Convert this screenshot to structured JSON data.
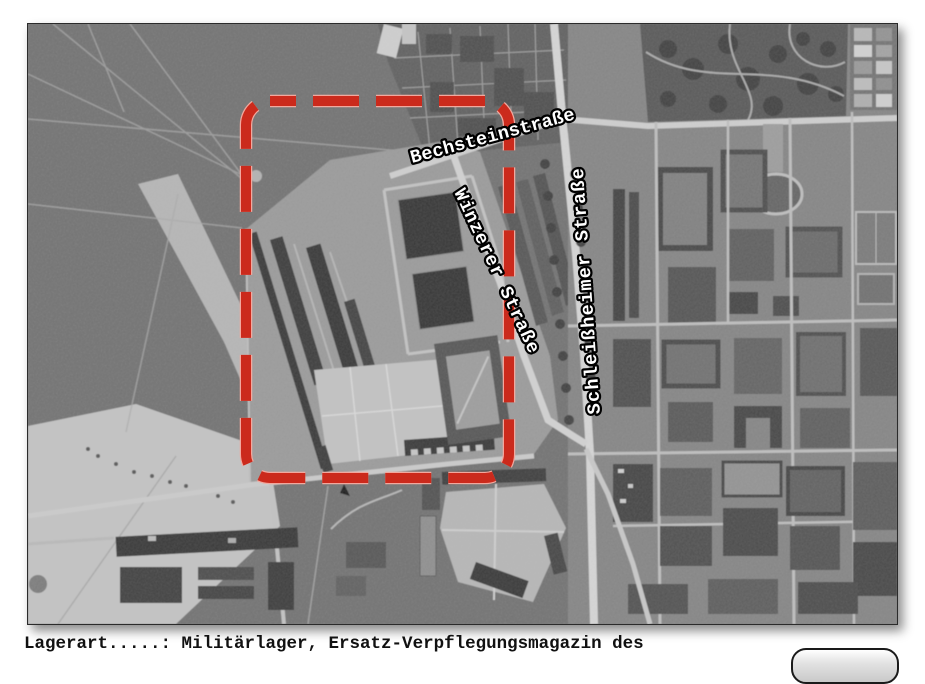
{
  "photo": {
    "street_labels": {
      "bechstein": "Bechsteinstraße",
      "winzerer": "Winzerer Straße",
      "schleissheimer": "Schleißheimer Straße"
    },
    "highlight_color": "#cb2a1c"
  },
  "caption": {
    "text": "Lagerart.....: Militärlager, Ersatz-Verpflegungsmagazin des"
  }
}
